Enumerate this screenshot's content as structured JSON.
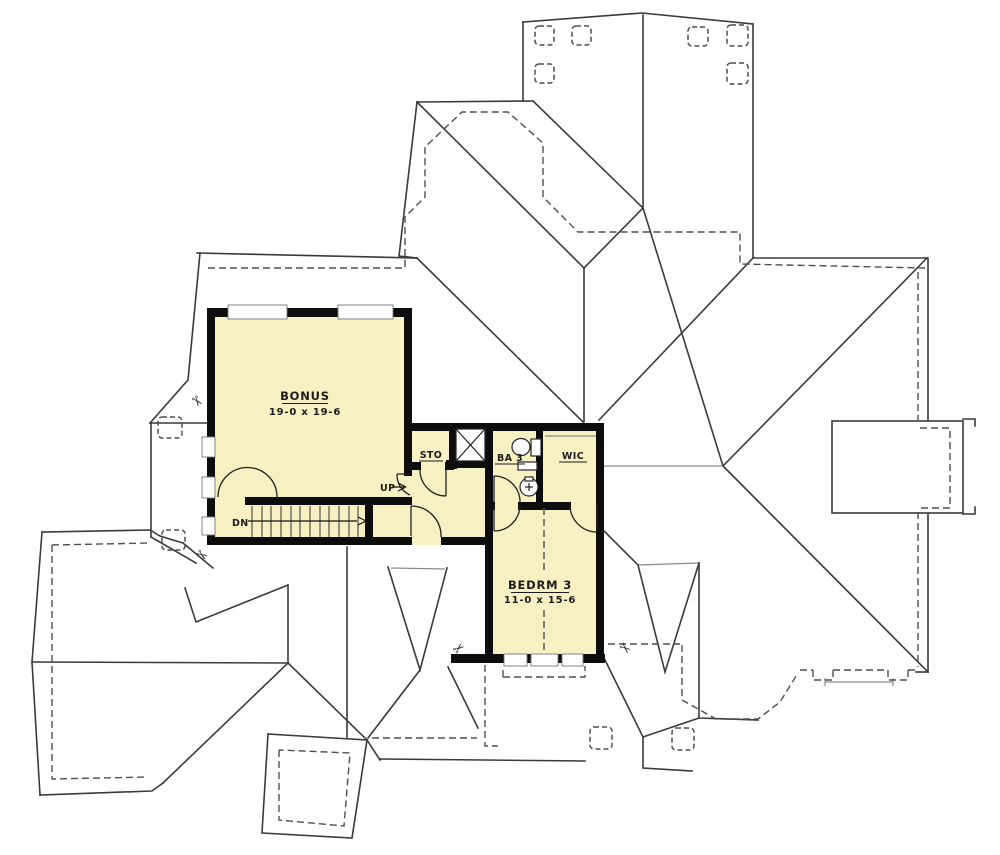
{
  "plan": {
    "title": "Second Floor Plan",
    "colors": {
      "background": "#ffffff",
      "room_fill": "#f6f0c3",
      "wall": "#0d0d0d",
      "roof_line": "#3a3a3a",
      "dashed_line": "#4f4f4f"
    },
    "rooms": {
      "bonus": {
        "label": "BONUS",
        "dims": "19-0 x 19-6"
      },
      "storage": {
        "label": "STO"
      },
      "bath": {
        "label": "BA 3"
      },
      "closet": {
        "label": "WIC"
      },
      "bedroom": {
        "label": "BEDRM 3",
        "dims": "11-0 x 15-6"
      }
    },
    "stairs": {
      "up_label": "UP",
      "down_label": "DN"
    }
  }
}
